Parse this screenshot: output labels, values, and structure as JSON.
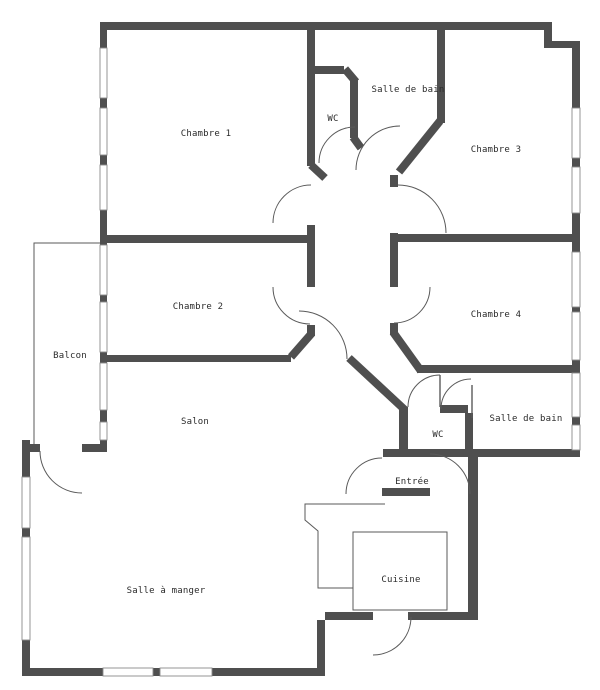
{
  "rooms": {
    "chambre1": "Chambre 1",
    "chambre2": "Chambre 2",
    "chambre3": "Chambre 3",
    "chambre4": "Chambre 4",
    "salle_de_bain_haut": "Salle de bain",
    "wc_haut": "WC",
    "balcon": "Balcon",
    "salon": "Salon",
    "salle_a_manger": "Salle à manger",
    "entree": "Entrée",
    "wc_bas": "WC",
    "salle_de_bain_bas": "Salle de bain",
    "cuisine": "Cuisine"
  },
  "colors": {
    "wall": "#4f4f4f",
    "line": "#5a5a5a",
    "text": "#2b2b2b",
    "background": "#ffffff"
  }
}
